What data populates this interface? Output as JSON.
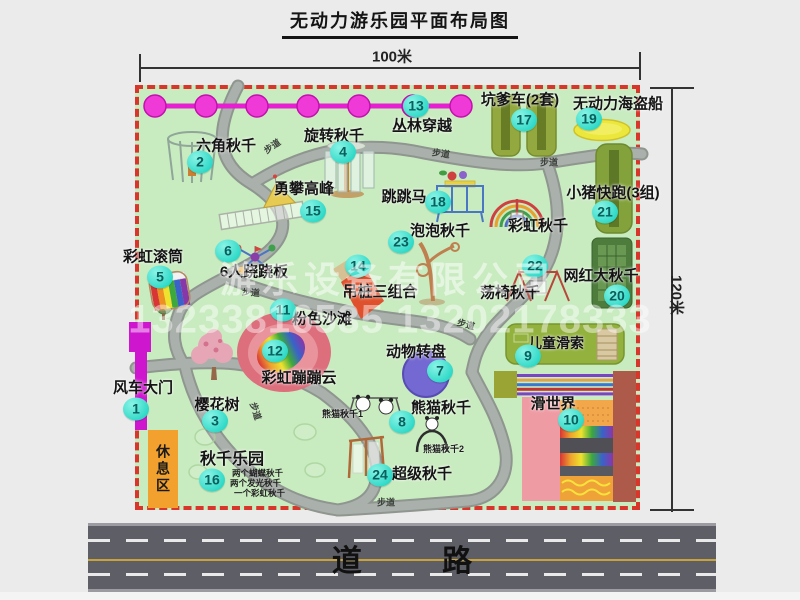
{
  "title": "无动力游乐园平面布局图",
  "dimensions": {
    "top": "100米",
    "right": "120米"
  },
  "road_label": "道 路",
  "path_label": "步道",
  "rest_area_label": "休息区",
  "watermark": {
    "company": "游乐设备有限公司",
    "phone": "13233816535 13202178333"
  },
  "attractions": [
    {
      "num": "1",
      "name": "风车大门"
    },
    {
      "num": "2",
      "name": "六角秋千"
    },
    {
      "num": "3",
      "name": "樱花树"
    },
    {
      "num": "4",
      "name": "旋转秋千"
    },
    {
      "num": "5",
      "name": "彩虹滚筒"
    },
    {
      "num": "6",
      "name": "6人跷跷板"
    },
    {
      "num": "7",
      "name": "动物转盘"
    },
    {
      "num": "8",
      "name": "熊猫秋千"
    },
    {
      "num": "9",
      "name": "儿童滑索"
    },
    {
      "num": "10",
      "name": "滑世界"
    },
    {
      "num": "11",
      "name": "粉色沙滩"
    },
    {
      "num": "12",
      "name": "彩虹蹦蹦云"
    },
    {
      "num": "13",
      "name": "丛林穿越"
    },
    {
      "num": "14",
      "name": "吊桩三组合"
    },
    {
      "num": "15",
      "name": "勇攀高峰"
    },
    {
      "num": "16",
      "name": "秋千乐园"
    },
    {
      "num": "17",
      "name": "坑爹车(2套)"
    },
    {
      "num": "18",
      "name": "跳跳马"
    },
    {
      "num": "19",
      "name": "无动力海盗船"
    },
    {
      "num": "20",
      "name": "网红大秋千"
    },
    {
      "num": "21",
      "name": "小猪快跑(3组)"
    },
    {
      "num": "22",
      "name": "荡椅秋千"
    },
    {
      "num": "23",
      "name": "泡泡秋千"
    },
    {
      "num": "24",
      "name": "超级秋千"
    }
  ],
  "unnumbered": {
    "rainbow_swing": "彩虹秋千"
  },
  "sub_labels": {
    "panda_swing_1": "熊猫秋千1",
    "panda_swing_2": "熊猫秋千2",
    "swing_park_notes": [
      "两个蝴蝶秋千",
      "两个发光秋千",
      "一个彩虹秋千"
    ]
  },
  "colors": {
    "map_bg": "#c9ebc0",
    "border": "#d8352b",
    "badge": "#2cd8c6",
    "gate": "#cf16cf",
    "jungle_line": "#e620d0",
    "rest_area": "#f2a12e",
    "road": "#5e5e66"
  }
}
